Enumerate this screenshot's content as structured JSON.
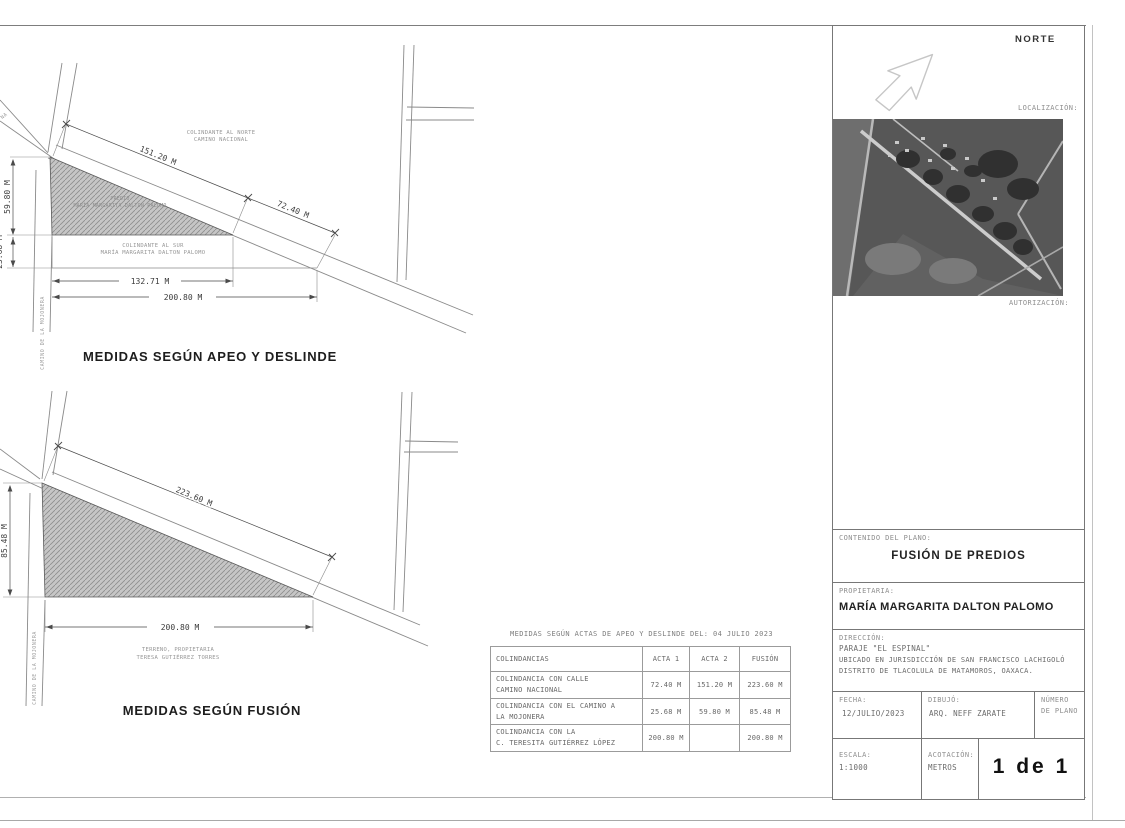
{
  "colors": {
    "paper": "#ffffff",
    "line": "#8a8a8a",
    "hatch_fill": "#c6c6c6",
    "hatch_line": "#8d8d8d",
    "text_dark": "#2e2e2e",
    "text_gray": "#8a8a8a"
  },
  "diagram_top": {
    "title": "MEDIDAS SEGÚN APEO Y DESLINDE",
    "edge_fragment": "NA",
    "colindante_norte_1": "COLINDANTE AL NORTE",
    "colindante_norte_2": "CAMINO NACIONAL",
    "parcel_1": "PREDIO",
    "parcel_2": "MARÍA MARGARITA DALTON PALOMO",
    "colindante_sur_1": "COLINDANTE AL SUR",
    "colindante_sur_2": "MARÍA MARGARITA DALTON PALOMO",
    "road_mojonera": "CAMINO DE LA MOJONERA",
    "dim_road_1": "151.20 M",
    "dim_road_2": "72.40 M",
    "dim_left_1": "59.80 M",
    "dim_left_2": "25.68 M",
    "dim_bottom_1": "132.71 M",
    "dim_bottom_2": "200.80 M"
  },
  "diagram_bottom": {
    "title": "MEDIDAS SEGÚN FUSIÓN",
    "owner_1": "TERRENO, PROPIETARIA",
    "owner_2": "TERESA GUTIÉRREZ TORRES",
    "road_mojonera": "CAMINO DE LA MOJONERA",
    "dim_road": "223.60 M",
    "dim_left": "85.48 M",
    "dim_bottom": "200.80 M"
  },
  "table": {
    "caption": "MEDIDAS SEGÚN ACTAS DE APEO Y DESLINDE DEL: 04 JULIO 2023",
    "headers": [
      "COLINDANCIAS",
      "ACTA 1",
      "ACTA 2",
      "FUSIÓN"
    ],
    "rows": [
      {
        "line1": "COLINDANCIA CON CALLE",
        "line2": "CAMINO NACIONAL",
        "acta1": "72.40 M",
        "acta2": "151.20 M",
        "fusion": "223.60 M"
      },
      {
        "line1": "COLINDANCIA CON EL CAMINO A",
        "line2": "LA MOJONERA",
        "acta1": "25.68 M",
        "acta2": "59.80 M",
        "fusion": "85.48 M"
      },
      {
        "line1": "COLINDANCIA CON LA",
        "line2": "C. TERESITA GUTIÉRREZ LÓPEZ",
        "acta1": "200.80 M",
        "acta2": "",
        "fusion": "200.80 M"
      }
    ]
  },
  "titleblock": {
    "norte": "NORTE",
    "localizacion": "LOCALIZACIÓN:",
    "autorizacion": "AUTORIZACIÓN:",
    "contenido_label": "CONTENIDO DEL PLANO:",
    "contenido_value": "FUSIÓN DE PREDIOS",
    "propietaria_label": "PROPIETARIA:",
    "propietaria_value": "MARÍA MARGARITA DALTON PALOMO",
    "direccion_label": "DIRECCIÓN:",
    "direccion_1": "PARAJE \"EL ESPINAL\"",
    "direccion_2": "UBICADO EN JURISDICCIÓN DE SAN FRANCISCO LACHIGOLÓ",
    "direccion_3": "DISTRITO DE TLACOLULA DE MATAMOROS, OAXACA.",
    "fecha_label": "FECHA:",
    "fecha_value": "12/JULIO/2023",
    "dibujo_label": "DIBUJÓ:",
    "dibujo_value": "ARQ. NEFF ZARATE",
    "numero_1": "NÚMERO",
    "numero_2": "DE PLANO",
    "escala_label": "ESCALA:",
    "escala_value": "1:1000",
    "acotacion_label": "ACOTACIÓN:",
    "acotacion_value": "METROS",
    "page": "1 de 1"
  }
}
